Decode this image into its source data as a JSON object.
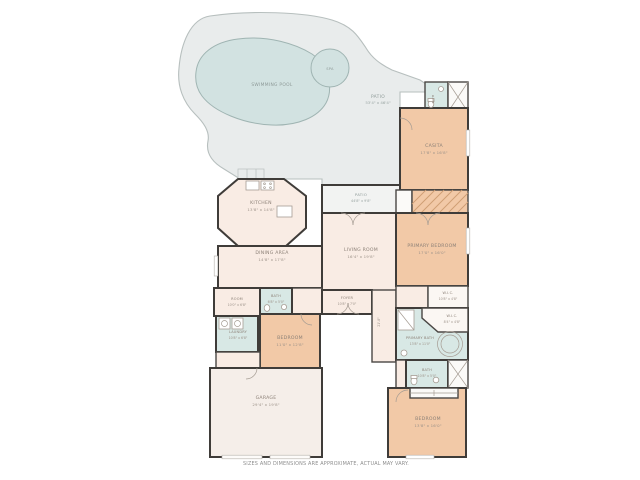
{
  "colors": {
    "deck": "#e9ecec",
    "pool_water": "#d2e2e1",
    "bedroom_peach": "#f2c9a7",
    "living_cream": "#f9ece4",
    "garage_cream": "#f5eee9",
    "bath_teal": "#d8e8e5",
    "wall_dark": "#3f3c39"
  },
  "outdoor": {
    "swimming_pool": {
      "name": "SWIMMING POOL"
    },
    "spa": {
      "name": "SPA"
    },
    "pool_patio": {
      "name": "PATIO",
      "dims": "53'4\" x 46'4\""
    },
    "covered_patio": {
      "name": "PATIO",
      "dims": "44'8\" x 9'8\""
    }
  },
  "rooms": {
    "kitchen": {
      "name": "KITCHEN",
      "dims": "13'8\" x 14'8\""
    },
    "dining": {
      "name": "DINING AREA",
      "dims": "14'8\" x 17'8\""
    },
    "living": {
      "name": "LIVING ROOM",
      "dims": "16'4\" x 19'8\""
    },
    "foyer": {
      "name": "FOYER",
      "dims": "10'8\" x 7'0\""
    },
    "casita": {
      "name": "CASITA",
      "dims": "17'8\" x 16'8\""
    },
    "casita_bath": {
      "name": "BATH",
      "dims": "8'4\" x 4'8\""
    },
    "primary_bedroom": {
      "name": "PRIMARY BEDROOM",
      "dims": "17'0\" x 16'0\""
    },
    "wic_1": {
      "name": "W.I.C.",
      "dims": "10'8\" x 4'8\""
    },
    "wic_2": {
      "name": "W.I.C.",
      "dims": "8'4\" x 4'8\""
    },
    "primary_bath": {
      "name": "PRIMARY BATH",
      "dims": "13'8\" x 11'0\""
    },
    "bath_right": {
      "name": "BATH",
      "dims": "10'8\" x 5'0\""
    },
    "bedroom_right": {
      "name": "BEDROOM",
      "dims": "13'8\" x 16'0\""
    },
    "bath_left": {
      "name": "BATH",
      "dims": "6'8\" x 5'0\""
    },
    "flex_room": {
      "name": "ROOM",
      "dims": "10'0\" x 6'8\""
    },
    "laundry": {
      "name": "LAUNDRY",
      "dims": "10'8\" x 6'8\""
    },
    "bedroom_left": {
      "name": "BEDROOM",
      "dims": "11'0\" x 12'8\""
    },
    "garage": {
      "name": "GARAGE",
      "dims": "29'4\" x 19'8\""
    }
  },
  "hall_dim": "21'-8\"",
  "footer": {
    "disclaimer": "SIZES AND DIMENSIONS ARE APPROXIMATE, ACTUAL MAY VARY."
  }
}
